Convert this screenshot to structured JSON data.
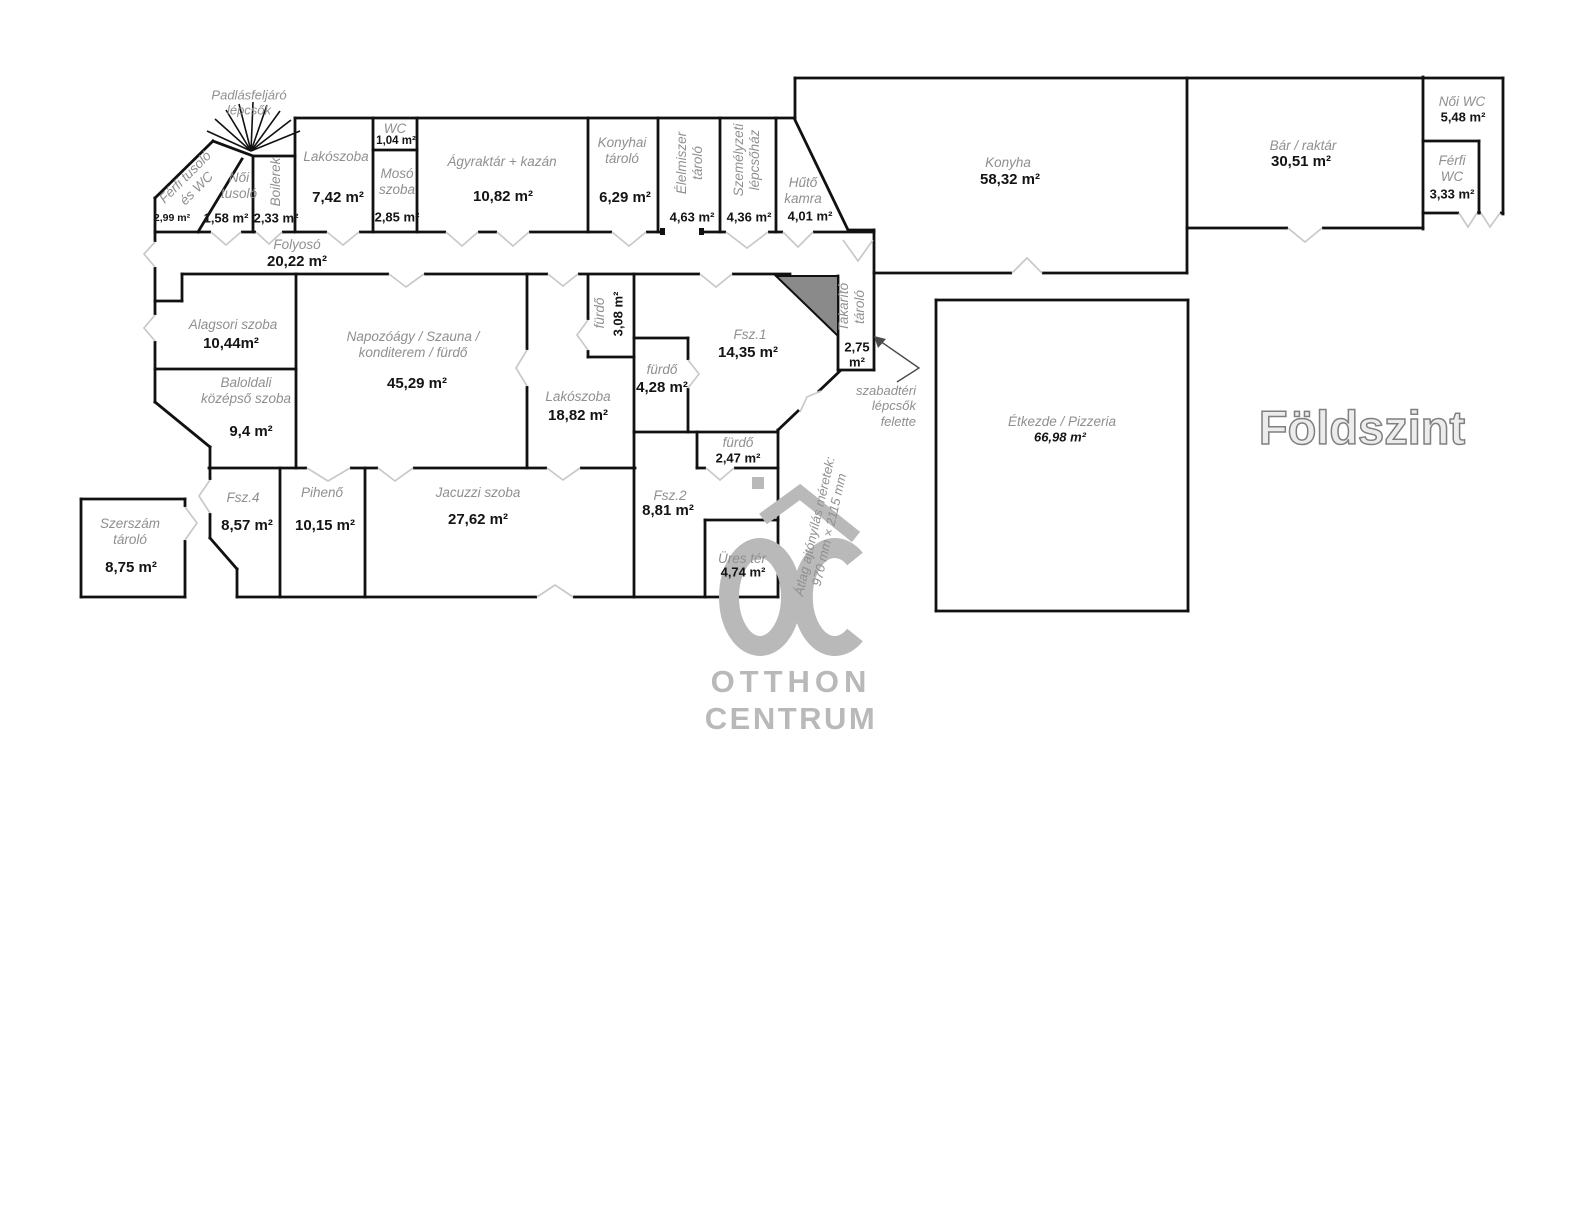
{
  "title": "Földszint",
  "watermark": {
    "line1": "OTTHON",
    "line2": "CENTRUM"
  },
  "annotations": {
    "attic_stairs": "Padlásfeljáró\nlépcsők",
    "outdoor_stairs": "szabadtéri\nlépcsők\nfelette",
    "door_note": "Átlag ajtónyílás méretek:\n970 mm × 2115 mm"
  },
  "colors": {
    "wall": "#111111",
    "room_name": "#8f8f8f",
    "area_text": "#141414",
    "door_mark": "#c9c9c9",
    "stair_fill": "#8a8a8a",
    "watermark": "#b9b9b9",
    "title_fill": "#ececec",
    "title_stroke": "#808080"
  },
  "rooms": [
    {
      "name": "Férfi tusoló\nés WC",
      "area": "2,99 m²"
    },
    {
      "name": "Női\ntusoló",
      "area": "1,58 m²"
    },
    {
      "name": "Boilerek",
      "area": "2,33 m²"
    },
    {
      "name": "Lakószoba",
      "area": "7,42 m²"
    },
    {
      "name": "WC",
      "area": "1,04 m²"
    },
    {
      "name": "Mosó\nszoba",
      "area": "2,85 m²"
    },
    {
      "name": "Ágyraktár + kazán",
      "area": "10,82 m²"
    },
    {
      "name": "Konyhai\ntároló",
      "area": "6,29 m²"
    },
    {
      "name": "Élelmiszer\ntároló",
      "area": "4,63 m²"
    },
    {
      "name": "Személyzeti\nlépcsőház",
      "area": "4,36 m²"
    },
    {
      "name": "Hűtő\nkamra",
      "area": "4,01 m²"
    },
    {
      "name": "Konyha",
      "area": "58,32 m²"
    },
    {
      "name": "Bár / raktár",
      "area": "30,51 m²"
    },
    {
      "name": "Női WC",
      "area": "5,48 m²"
    },
    {
      "name": "Férfi\nWC",
      "area": "3,33 m²"
    },
    {
      "name": "Folyosó",
      "area": "20,22 m²"
    },
    {
      "name": "Alagsori szoba",
      "area": "10,44m²"
    },
    {
      "name": "Baloldali\nközépső szoba",
      "area": "9,4 m²"
    },
    {
      "name": "Napozóágy / Szauna /\nkonditerem / fürdő",
      "area": "45,29 m²"
    },
    {
      "name": "fürdő",
      "area": "3,08 m²"
    },
    {
      "name": "Lakószoba",
      "area": "18,82 m²"
    },
    {
      "name": "fürdő",
      "area": "4,28 m²"
    },
    {
      "name": "Fsz.1",
      "area": "14,35 m²"
    },
    {
      "name": "Takarító\ntároló",
      "area": "2,75\nm²"
    },
    {
      "name": "fürdő",
      "area": "2,47 m²"
    },
    {
      "name": "Szerszám\ntároló",
      "area": "8,75 m²"
    },
    {
      "name": "Fsz.4",
      "area": "8,57 m²"
    },
    {
      "name": "Pihenő",
      "area": "10,15 m²"
    },
    {
      "name": "Jacuzzi szoba",
      "area": "27,62 m²"
    },
    {
      "name": "Fsz.2",
      "area": "8,81 m²"
    },
    {
      "name": "Üres tér",
      "area": "4,74 m²"
    },
    {
      "name": "Étkezde / Pizzeria",
      "area": "66,98 m²"
    }
  ]
}
